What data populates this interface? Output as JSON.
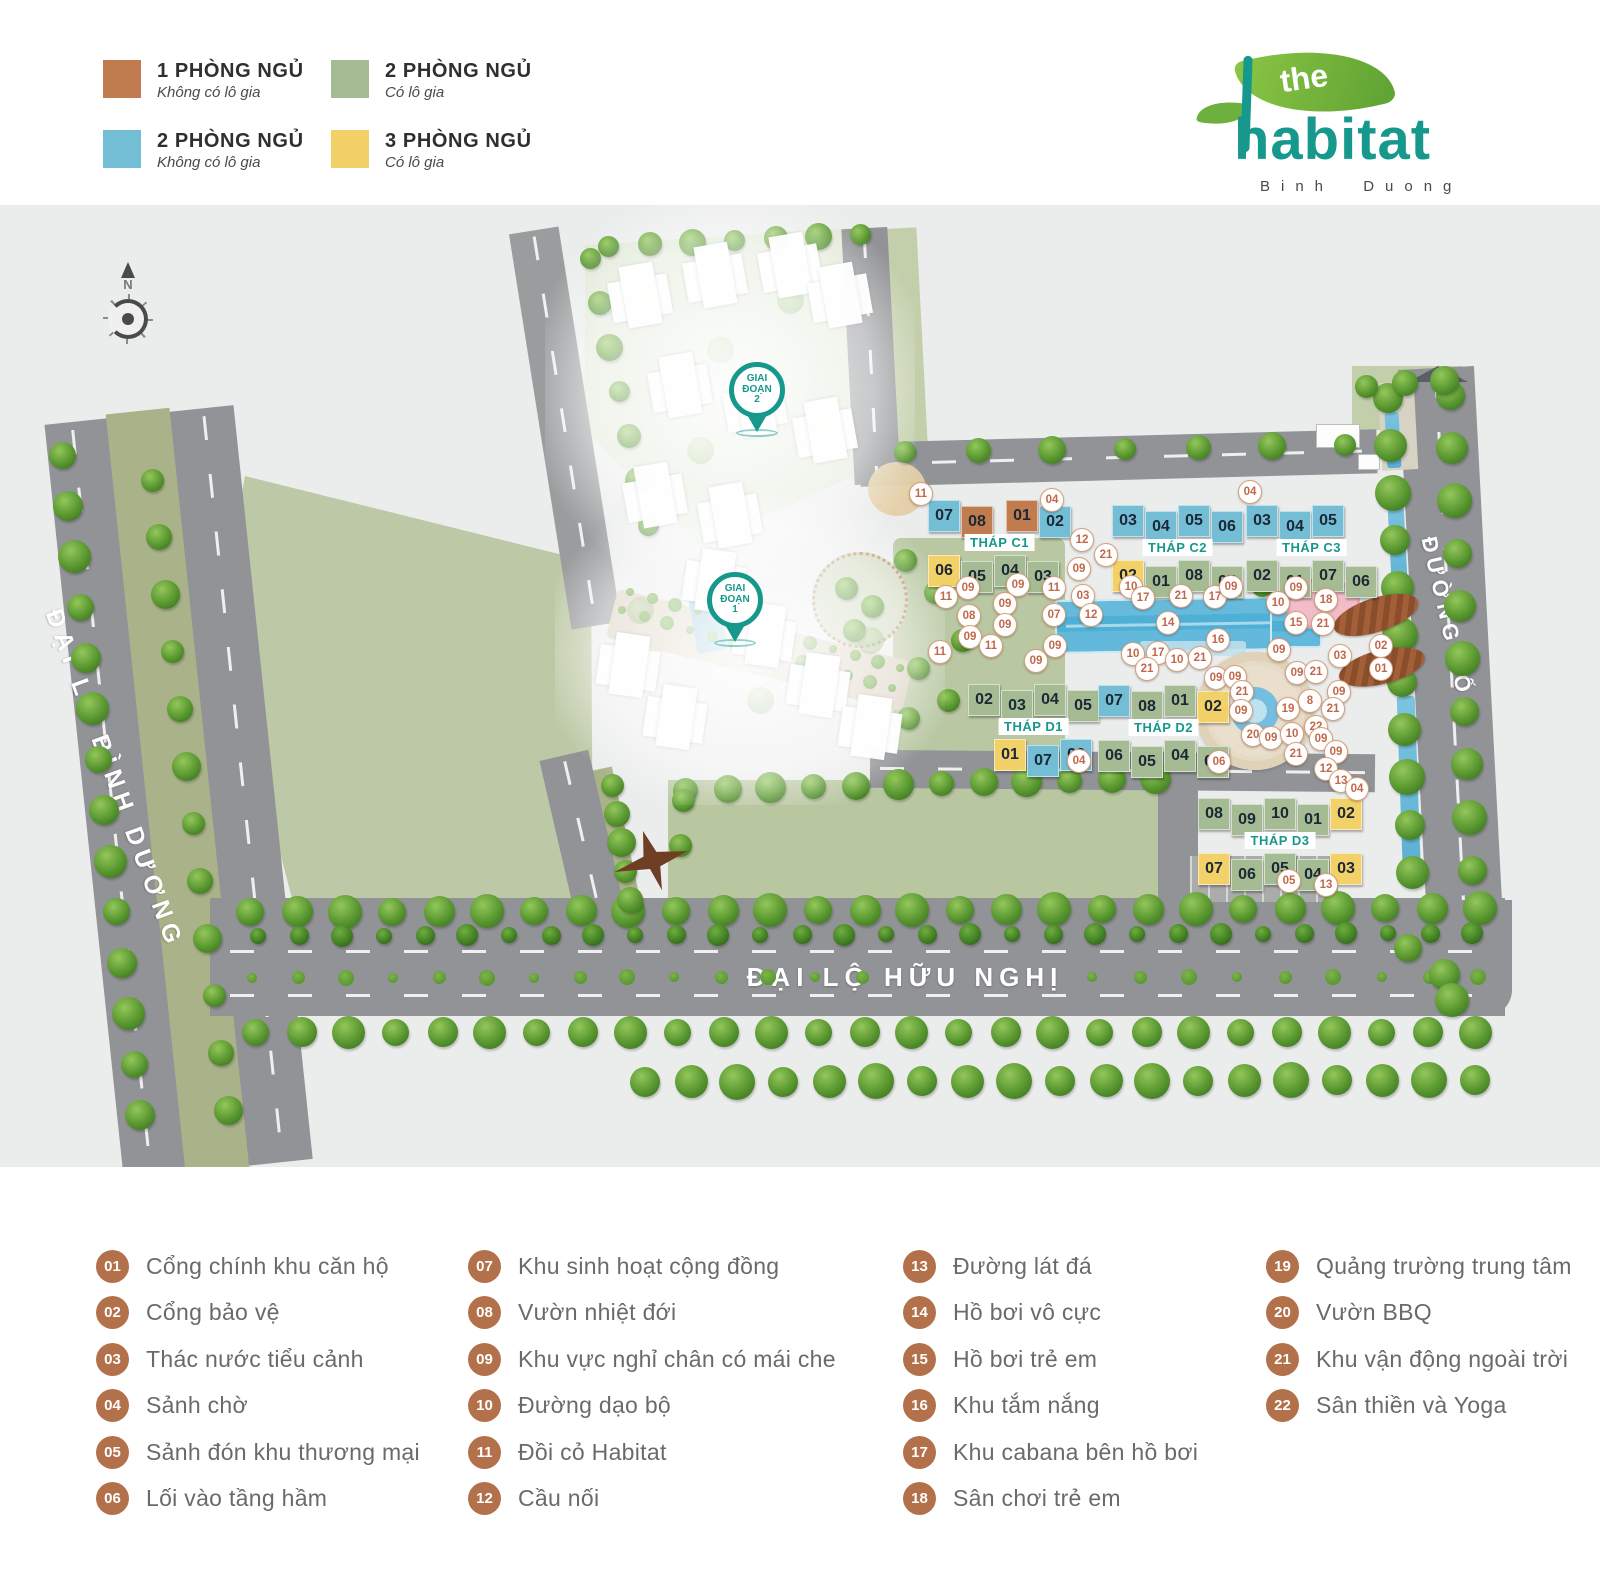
{
  "unit_legend": {
    "items": [
      {
        "color": "#c07b4e",
        "title": "1 PHÒNG NGỦ",
        "subtitle": "Không có lô gia"
      },
      {
        "color": "#a5bb93",
        "title": "2 PHÒNG NGỦ",
        "subtitle": "Có lô gia"
      },
      {
        "color": "#73bdd5",
        "title": "2 PHÒNG NGỦ",
        "subtitle": "Không có lô gia"
      },
      {
        "color": "#f3d169",
        "title": "3 PHÒNG NGỦ",
        "subtitle": "Có lô gia"
      }
    ]
  },
  "logo": {
    "the": "the",
    "name": "habitat",
    "location": "Binh Duong"
  },
  "map": {
    "compass": "N",
    "roads": {
      "left": "ĐẠI LỘ BÌNH DƯƠNG",
      "bottom": "ĐẠI LỘ HỮU NGHỊ",
      "right": "ĐƯỜNG SỐ 3"
    },
    "unit_colors": {
      "brown": "#c07b4e",
      "green": "#a5bb93",
      "blue": "#73bdd5",
      "yellow": "#f3d169"
    },
    "accent_teal": "#17988c",
    "marker_color": "#c2684a",
    "phase_pins": [
      {
        "lines": [
          "GIAI",
          "ĐOẠN",
          "2"
        ],
        "x": 757,
        "y": 362
      },
      {
        "lines": [
          "GIAI",
          "ĐOẠN",
          "1"
        ],
        "x": 735,
        "y": 572
      }
    ],
    "towers": [
      {
        "label": "THÁP C1",
        "x": 928,
        "y": 500,
        "top": [
          {
            "n": "07",
            "c": "blue"
          },
          {
            "n": "08",
            "c": "brown"
          },
          {
            "n": "01",
            "c": "brown"
          },
          {
            "n": "02",
            "c": "blue"
          }
        ],
        "bottom": [
          {
            "n": "06",
            "c": "yellow"
          },
          {
            "n": "05",
            "c": "green"
          },
          {
            "n": "04",
            "c": "green"
          },
          {
            "n": "03",
            "c": "green"
          }
        ]
      },
      {
        "label": "THÁP C2",
        "x": 1112,
        "y": 505,
        "top": [
          {
            "n": "03",
            "c": "blue"
          },
          {
            "n": "04",
            "c": "blue"
          },
          {
            "n": "05",
            "c": "blue"
          },
          {
            "n": "06",
            "c": "blue"
          }
        ],
        "bottom": [
          {
            "n": "02",
            "c": "yellow"
          },
          {
            "n": "01",
            "c": "green"
          },
          {
            "n": "08",
            "c": "green"
          },
          {
            "n": "07",
            "c": "green"
          }
        ]
      },
      {
        "label": "THÁP C3",
        "x": 1246,
        "y": 505,
        "top": [
          {
            "n": "03",
            "c": "blue"
          },
          {
            "n": "04",
            "c": "blue"
          },
          {
            "n": "05",
            "c": "blue"
          }
        ],
        "bottom": [
          {
            "n": "02",
            "c": "green"
          },
          {
            "n": "01",
            "c": "green"
          },
          {
            "n": "07",
            "c": "green"
          },
          {
            "n": "06",
            "c": "green"
          }
        ]
      },
      {
        "label": "THÁP D1",
        "x": 968,
        "y": 684,
        "top": [
          {
            "n": "02",
            "c": "green"
          },
          {
            "n": "03",
            "c": "green"
          },
          {
            "n": "04",
            "c": "green"
          },
          {
            "n": "05",
            "c": "green"
          }
        ],
        "bottom": [
          {
            "n": "01",
            "c": "yellow"
          },
          {
            "n": "07",
            "c": "blue"
          },
          {
            "n": "06",
            "c": "blue"
          }
        ]
      },
      {
        "label": "THÁP D2",
        "x": 1098,
        "y": 685,
        "top": [
          {
            "n": "07",
            "c": "blue"
          },
          {
            "n": "08",
            "c": "green"
          },
          {
            "n": "01",
            "c": "green"
          },
          {
            "n": "02",
            "c": "yellow"
          }
        ],
        "bottom": [
          {
            "n": "06",
            "c": "green"
          },
          {
            "n": "05",
            "c": "green"
          },
          {
            "n": "04",
            "c": "green"
          },
          {
            "n": "03",
            "c": "green"
          }
        ]
      },
      {
        "label": "THÁP D3",
        "x": 1198,
        "y": 798,
        "top": [
          {
            "n": "08",
            "c": "green"
          },
          {
            "n": "09",
            "c": "green"
          },
          {
            "n": "10",
            "c": "green"
          },
          {
            "n": "01",
            "c": "green"
          },
          {
            "n": "02",
            "c": "yellow"
          }
        ],
        "bottom": [
          {
            "n": "07",
            "c": "yellow"
          },
          {
            "n": "06",
            "c": "green"
          },
          {
            "n": "05",
            "c": "green"
          },
          {
            "n": "04",
            "c": "green"
          },
          {
            "n": "03",
            "c": "yellow"
          }
        ]
      }
    ],
    "markers": [
      {
        "n": "11",
        "x": 921,
        "y": 494
      },
      {
        "n": "04",
        "x": 1052,
        "y": 500
      },
      {
        "n": "04",
        "x": 1250,
        "y": 492
      },
      {
        "n": "12",
        "x": 1082,
        "y": 540
      },
      {
        "n": "21",
        "x": 1106,
        "y": 555
      },
      {
        "n": "09",
        "x": 1079,
        "y": 569
      },
      {
        "n": "09",
        "x": 1018,
        "y": 585
      },
      {
        "n": "11",
        "x": 1054,
        "y": 588
      },
      {
        "n": "03",
        "x": 1083,
        "y": 596
      },
      {
        "n": "09",
        "x": 968,
        "y": 588
      },
      {
        "n": "11",
        "x": 946,
        "y": 597
      },
      {
        "n": "09",
        "x": 1005,
        "y": 604
      },
      {
        "n": "08",
        "x": 969,
        "y": 616
      },
      {
        "n": "07",
        "x": 1054,
        "y": 615
      },
      {
        "n": "12",
        "x": 1091,
        "y": 615
      },
      {
        "n": "09",
        "x": 1005,
        "y": 625
      },
      {
        "n": "09",
        "x": 970,
        "y": 637
      },
      {
        "n": "11",
        "x": 940,
        "y": 652
      },
      {
        "n": "11",
        "x": 991,
        "y": 646
      },
      {
        "n": "09",
        "x": 1055,
        "y": 646
      },
      {
        "n": "09",
        "x": 1036,
        "y": 661
      },
      {
        "n": "10",
        "x": 1131,
        "y": 587
      },
      {
        "n": "17",
        "x": 1143,
        "y": 598
      },
      {
        "n": "21",
        "x": 1181,
        "y": 596
      },
      {
        "n": "17",
        "x": 1215,
        "y": 597
      },
      {
        "n": "09",
        "x": 1231,
        "y": 587
      },
      {
        "n": "14",
        "x": 1168,
        "y": 623
      },
      {
        "n": "16",
        "x": 1218,
        "y": 640
      },
      {
        "n": "10",
        "x": 1278,
        "y": 603
      },
      {
        "n": "15",
        "x": 1296,
        "y": 623
      },
      {
        "n": "18",
        "x": 1326,
        "y": 600
      },
      {
        "n": "21",
        "x": 1323,
        "y": 624
      },
      {
        "n": "09",
        "x": 1296,
        "y": 588
      },
      {
        "n": "10",
        "x": 1133,
        "y": 654
      },
      {
        "n": "17",
        "x": 1158,
        "y": 653
      },
      {
        "n": "10",
        "x": 1177,
        "y": 660
      },
      {
        "n": "21",
        "x": 1200,
        "y": 658
      },
      {
        "n": "21",
        "x": 1147,
        "y": 669
      },
      {
        "n": "09",
        "x": 1216,
        "y": 678
      },
      {
        "n": "09",
        "x": 1235,
        "y": 677
      },
      {
        "n": "09",
        "x": 1279,
        "y": 650
      },
      {
        "n": "03",
        "x": 1340,
        "y": 656
      },
      {
        "n": "09",
        "x": 1297,
        "y": 673
      },
      {
        "n": "21",
        "x": 1316,
        "y": 672
      },
      {
        "n": "09",
        "x": 1339,
        "y": 692
      },
      {
        "n": "21",
        "x": 1242,
        "y": 692
      },
      {
        "n": "09",
        "x": 1241,
        "y": 711
      },
      {
        "n": "19",
        "x": 1288,
        "y": 709
      },
      {
        "n": "8",
        "x": 1310,
        "y": 701
      },
      {
        "n": "21",
        "x": 1333,
        "y": 709
      },
      {
        "n": "22",
        "x": 1316,
        "y": 727
      },
      {
        "n": "20",
        "x": 1253,
        "y": 735
      },
      {
        "n": "09",
        "x": 1271,
        "y": 738
      },
      {
        "n": "10",
        "x": 1292,
        "y": 734
      },
      {
        "n": "09",
        "x": 1321,
        "y": 739
      },
      {
        "n": "21",
        "x": 1296,
        "y": 754
      },
      {
        "n": "09",
        "x": 1336,
        "y": 752
      },
      {
        "n": "12",
        "x": 1326,
        "y": 769
      },
      {
        "n": "13",
        "x": 1341,
        "y": 781
      },
      {
        "n": "04",
        "x": 1357,
        "y": 789
      },
      {
        "n": "04",
        "x": 1079,
        "y": 761
      },
      {
        "n": "06",
        "x": 1219,
        "y": 762
      },
      {
        "n": "05",
        "x": 1289,
        "y": 881
      },
      {
        "n": "13",
        "x": 1326,
        "y": 885
      },
      {
        "n": "02",
        "x": 1381,
        "y": 646
      },
      {
        "n": "01",
        "x": 1381,
        "y": 669
      }
    ]
  },
  "amenity_legend": {
    "columns": [
      [
        {
          "num": "01",
          "label": "Cổng chính khu căn hộ"
        },
        {
          "num": "02",
          "label": "Cổng bảo vệ"
        },
        {
          "num": "03",
          "label": "Thác nước tiểu cảnh"
        },
        {
          "num": "04",
          "label": "Sảnh chờ"
        },
        {
          "num": "05",
          "label": "Sảnh đón khu thương mại"
        },
        {
          "num": "06",
          "label": "Lối vào tầng hầm"
        }
      ],
      [
        {
          "num": "07",
          "label": "Khu sinh hoạt cộng đồng"
        },
        {
          "num": "08",
          "label": "Vườn nhiệt đới"
        },
        {
          "num": "09",
          "label": "Khu vực nghỉ chân có mái che"
        },
        {
          "num": "10",
          "label": "Đường dạo bộ"
        },
        {
          "num": "11",
          "label": "Đồi cỏ Habitat"
        },
        {
          "num": "12",
          "label": "Cầu nối"
        }
      ],
      [
        {
          "num": "13",
          "label": "Đường lát đá"
        },
        {
          "num": "14",
          "label": "Hồ bơi vô cực"
        },
        {
          "num": "15",
          "label": "Hồ bơi trẻ em"
        },
        {
          "num": "16",
          "label": "Khu tắm nắng"
        },
        {
          "num": "17",
          "label": "Khu cabana bên hồ bơi"
        },
        {
          "num": "18",
          "label": "Sân chơi trẻ em"
        }
      ],
      [
        {
          "num": "19",
          "label": "Quảng trường trung tâm"
        },
        {
          "num": "20",
          "label": "Vườn BBQ"
        },
        {
          "num": "21",
          "label": "Khu vận động ngoài trời"
        },
        {
          "num": "22",
          "label": "Sân thiền và Yoga"
        }
      ]
    ]
  }
}
